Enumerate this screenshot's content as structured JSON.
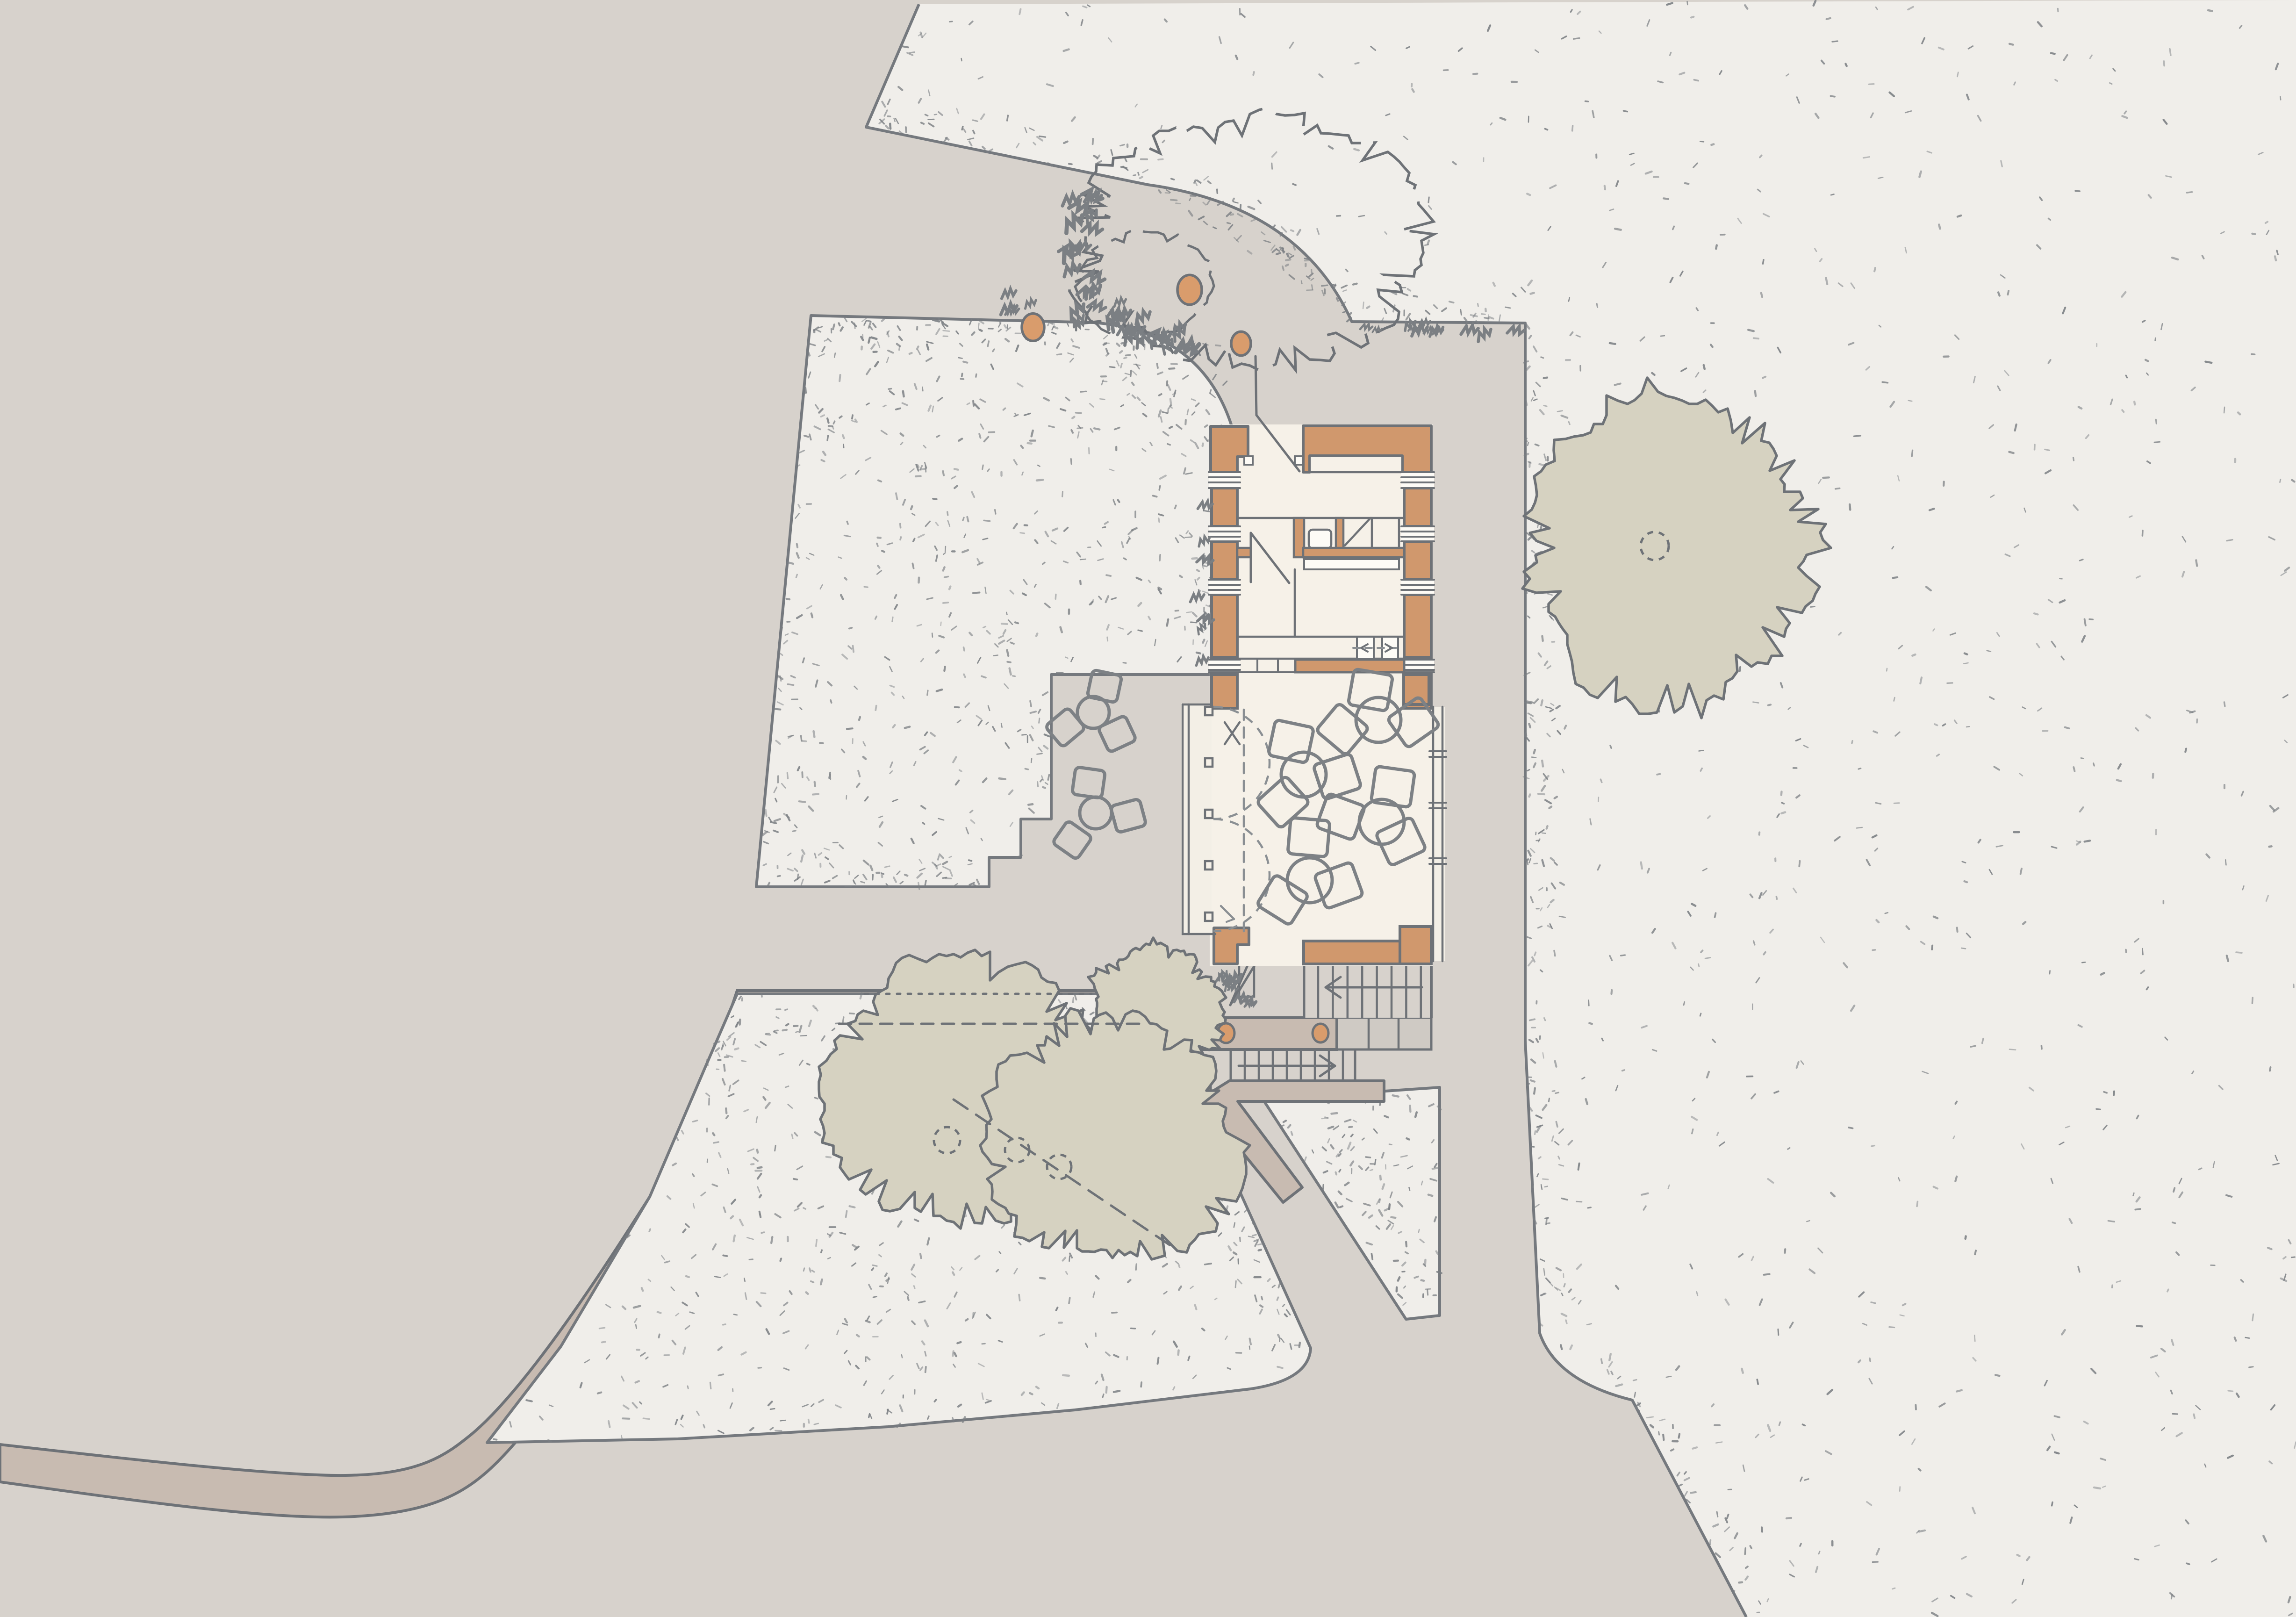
{
  "document": {
    "kind": "hand-drawn architectural site plan",
    "title": "",
    "visible_text": [],
    "orientation": "landscape"
  },
  "palette": {
    "background": "#d7d2cc",
    "lawn": "#f0eeea",
    "lawn_edge": "#75797e",
    "path_taupe": "#c8bbb1",
    "path_gray": "#ccc7c2",
    "steps_gray": "#cfcac4",
    "wall_terracotta": "#d0986d",
    "interior_cream": "#f6f1e8",
    "veranda_white": "#f3efe6",
    "tree_sage": "#d6d2c1",
    "trunk_orange": "#d99c6c",
    "line_dark": "#6e7277",
    "line_mid": "#7d8185",
    "line_soft": "#8a8f93"
  },
  "scene": {
    "building": {
      "walls": "terracotta masonry with window gaps",
      "rooms": [
        "entry hall with kitchen band",
        "small wc compartments",
        "large dining room with folding veranda doors"
      ],
      "dining_tables": 4,
      "dining_chairs": 12,
      "stair_runs": 2,
      "stair_arrows": [
        "up-left",
        "down-right"
      ]
    },
    "site": {
      "terrace_tables": 2,
      "terrace_chairs": 6,
      "filled_trees": 4,
      "outline_trees": 1,
      "trunk_markers_orange": 5,
      "trunk_markers_dashed": 4,
      "lawns": 4,
      "curving_roads": 2,
      "landing_columns": 2
    }
  }
}
